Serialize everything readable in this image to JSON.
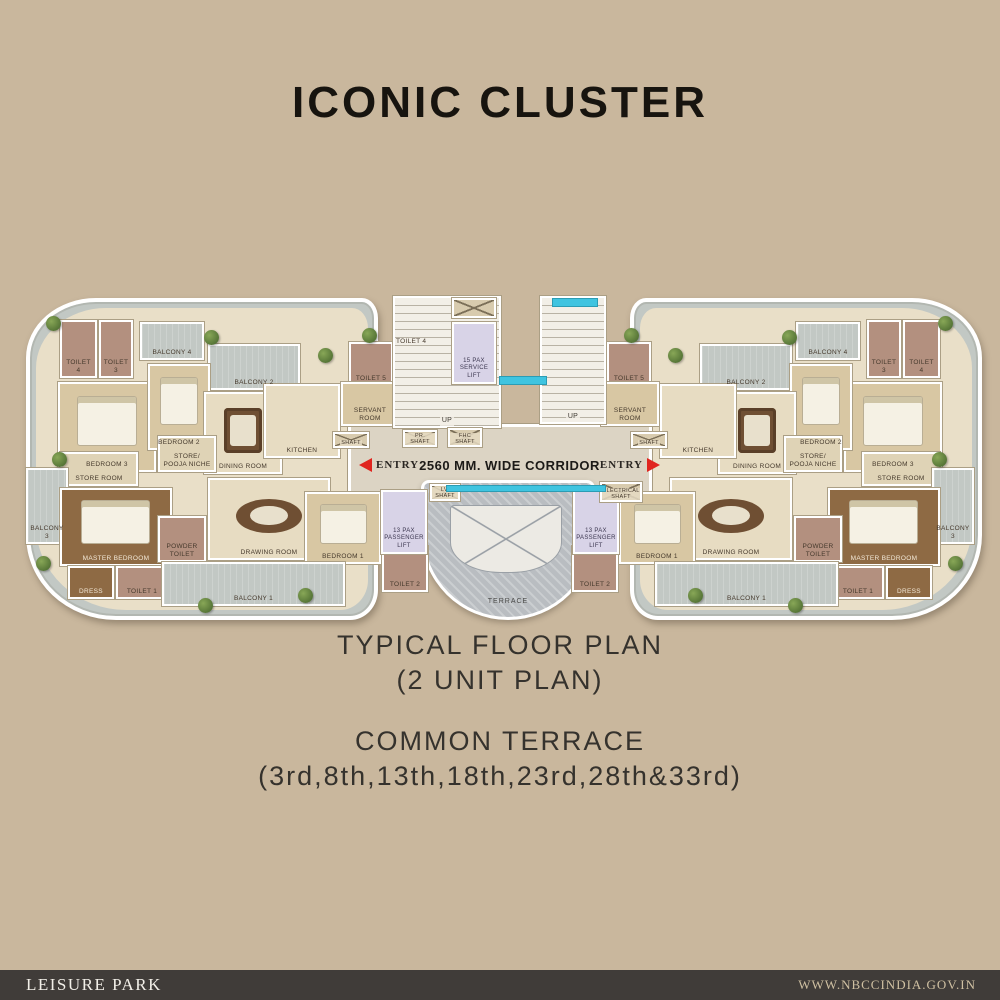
{
  "title": "ICONIC CLUSTER",
  "captions": {
    "line1": "TYPICAL FLOOR PLAN",
    "line2": "(2 UNIT PLAN)",
    "line3": "COMMON TERRACE",
    "line4": "(3rd,8th,13th,18th,23rd,28th&33rd)"
  },
  "footer": {
    "left": "LEISURE PARK",
    "right": "WWW.NBCCINDIA.GOV.IN"
  },
  "colors": {
    "background_tan": "#c9b79d",
    "footer_bar": "#403c39",
    "entry_arrow_red": "#e0251f",
    "water_cyan": "#3fc4e0",
    "lift_lavender": "#d8d3e7",
    "balcony_gray": "#c2c8c4",
    "floor_cream": "#e7dcc2",
    "toilet_mauve": "#b3907f",
    "bedroom_tan": "#d8c7a3",
    "wood_brown": "#8e6a44",
    "terrace_gray": "#b9bdc1"
  },
  "plan": {
    "corridor_label": "2560 MM. WIDE CORRIDOR",
    "entry_label": "ENTRY",
    "terrace_label": "TERRACE",
    "stair_toilet_label": "TOILET 4",
    "unit_rooms": [
      {
        "label": "TOILET 4",
        "x": 60,
        "y": 320,
        "w": 37,
        "h": 58,
        "type": "toilet"
      },
      {
        "label": "TOILET 3",
        "x": 99,
        "y": 320,
        "w": 34,
        "h": 58,
        "type": "toilet"
      },
      {
        "label": "BALCONY 4",
        "x": 140,
        "y": 322,
        "w": 64,
        "h": 38,
        "type": "balcony"
      },
      {
        "label": "BALCONY 2",
        "x": 208,
        "y": 344,
        "w": 92,
        "h": 46,
        "type": "balcony"
      },
      {
        "label": "BEDROOM 3",
        "x": 58,
        "y": 382,
        "w": 98,
        "h": 90,
        "type": "bedroom",
        "accent": "bed"
      },
      {
        "label": "BEDROOM 2",
        "x": 148,
        "y": 364,
        "w": 62,
        "h": 86,
        "type": "bedroom",
        "accent": "bed"
      },
      {
        "label": "DINING ROOM",
        "x": 204,
        "y": 392,
        "w": 78,
        "h": 82,
        "type": "cream",
        "accent": "table"
      },
      {
        "label": "KITCHEN",
        "x": 264,
        "y": 384,
        "w": 76,
        "h": 74,
        "type": "cream"
      },
      {
        "label": "TOILET 5",
        "x": 349,
        "y": 342,
        "w": 44,
        "h": 44,
        "type": "toilet"
      },
      {
        "label": "SERVANT ROOM",
        "x": 341,
        "y": 382,
        "w": 58,
        "h": 44,
        "type": "bedroom"
      },
      {
        "label": "STORE/ POOJA NICHE",
        "x": 158,
        "y": 436,
        "w": 58,
        "h": 36,
        "type": "store"
      },
      {
        "label": "STORE ROOM",
        "x": 60,
        "y": 452,
        "w": 78,
        "h": 34,
        "type": "store"
      },
      {
        "label": "BALCONY 3",
        "x": 26,
        "y": 468,
        "w": 42,
        "h": 76,
        "type": "balcony"
      },
      {
        "label": "MASTER BEDROOM",
        "x": 60,
        "y": 488,
        "w": 112,
        "h": 78,
        "type": "wood",
        "accent": "bed"
      },
      {
        "label": "DRESS",
        "x": 68,
        "y": 566,
        "w": 46,
        "h": 33,
        "type": "wood"
      },
      {
        "label": "TOILET 1",
        "x": 116,
        "y": 566,
        "w": 52,
        "h": 33,
        "type": "toilet"
      },
      {
        "label": "POWDER TOILET",
        "x": 158,
        "y": 516,
        "w": 48,
        "h": 46,
        "type": "toilet"
      },
      {
        "label": "DRAWING ROOM",
        "x": 208,
        "y": 478,
        "w": 122,
        "h": 82,
        "type": "cream",
        "accent": "oval"
      },
      {
        "label": "BEDROOM 1",
        "x": 305,
        "y": 492,
        "w": 76,
        "h": 72,
        "type": "bedroom",
        "accent": "bed"
      },
      {
        "label": "BALCONY 1",
        "x": 162,
        "y": 562,
        "w": 183,
        "h": 44,
        "type": "balcony"
      },
      {
        "label": "TOILET 2",
        "x": 382,
        "y": 546,
        "w": 46,
        "h": 46,
        "type": "toilet"
      },
      {
        "label": "SHAFT",
        "x": 333,
        "y": 432,
        "w": 36,
        "h": 16,
        "type": "shaft"
      },
      {
        "label": "13 PAX PASSENGER LIFT",
        "x": 381,
        "y": 490,
        "w": 46,
        "h": 64,
        "type": "lift"
      }
    ],
    "core": [
      {
        "label": "UP",
        "x": 393,
        "y": 296,
        "w": 108,
        "h": 132,
        "type": "stair"
      },
      {
        "label": "UP",
        "x": 540,
        "y": 296,
        "w": 66,
        "h": 128,
        "type": "stair"
      },
      {
        "label": "",
        "x": 452,
        "y": 298,
        "w": 44,
        "h": 20,
        "type": "shaft"
      },
      {
        "label": "15 PAX SERVICE LIFT",
        "x": 452,
        "y": 322,
        "w": 44,
        "h": 62,
        "type": "lift"
      },
      {
        "label": "PR. SHAFT",
        "x": 403,
        "y": 430,
        "w": 34,
        "h": 17,
        "type": "shaft"
      },
      {
        "label": "FHC SHAFT",
        "x": 448,
        "y": 428,
        "w": 34,
        "h": 19,
        "type": "shaft"
      },
      {
        "label": "LV. SHAFT",
        "x": 430,
        "y": 484,
        "w": 30,
        "h": 17,
        "type": "shaft"
      },
      {
        "label": "ELECTRICAL SHAFT",
        "x": 600,
        "y": 482,
        "w": 42,
        "h": 20,
        "type": "shaft"
      }
    ],
    "cyan_strips": [
      {
        "x": 500,
        "y": 377,
        "w": 46,
        "h": 7
      },
      {
        "x": 553,
        "y": 299,
        "w": 44,
        "h": 7
      },
      {
        "x": 447,
        "y": 486,
        "w": 158,
        "h": 5
      }
    ],
    "trees": [
      [
        46,
        316
      ],
      [
        204,
        330
      ],
      [
        318,
        348
      ],
      [
        52,
        452
      ],
      [
        36,
        556
      ],
      [
        198,
        598
      ],
      [
        298,
        588
      ],
      [
        362,
        328
      ],
      [
        938,
        316
      ],
      [
        782,
        330
      ],
      [
        668,
        348
      ],
      [
        932,
        452
      ],
      [
        948,
        556
      ],
      [
        788,
        598
      ],
      [
        688,
        588
      ],
      [
        624,
        328
      ]
    ]
  }
}
